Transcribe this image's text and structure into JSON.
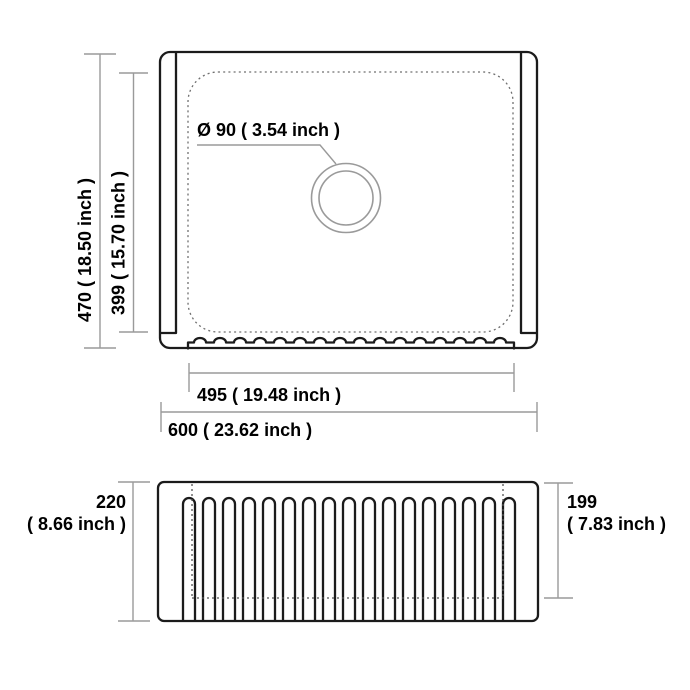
{
  "title": "Farmhouse sink dimension drawing",
  "top_view": {
    "drain_diameter_label": "Ø 90 ( 3.54 inch )",
    "outer_depth_label": "470 ( 18.50 inch )",
    "bowl_depth_label": "399 ( 15.70 inch )",
    "bowl_width_label": "495 ( 19.48 inch )",
    "overall_width_label": "600 ( 23.62 inch )"
  },
  "front_view": {
    "overall_height_mm": "220",
    "overall_height_inch": "( 8.66 inch )",
    "bowl_height_mm": "199",
    "bowl_height_inch": "( 7.83 inch )"
  },
  "colors": {
    "outline": "#1b1b1b",
    "dimension_line": "#9a9a9a",
    "dashed_bowl": "#6f6f6f",
    "dotted_hidden": "#555555",
    "drain_circle": "#9a9a9a",
    "text": "#000000",
    "background": "#ffffff"
  }
}
